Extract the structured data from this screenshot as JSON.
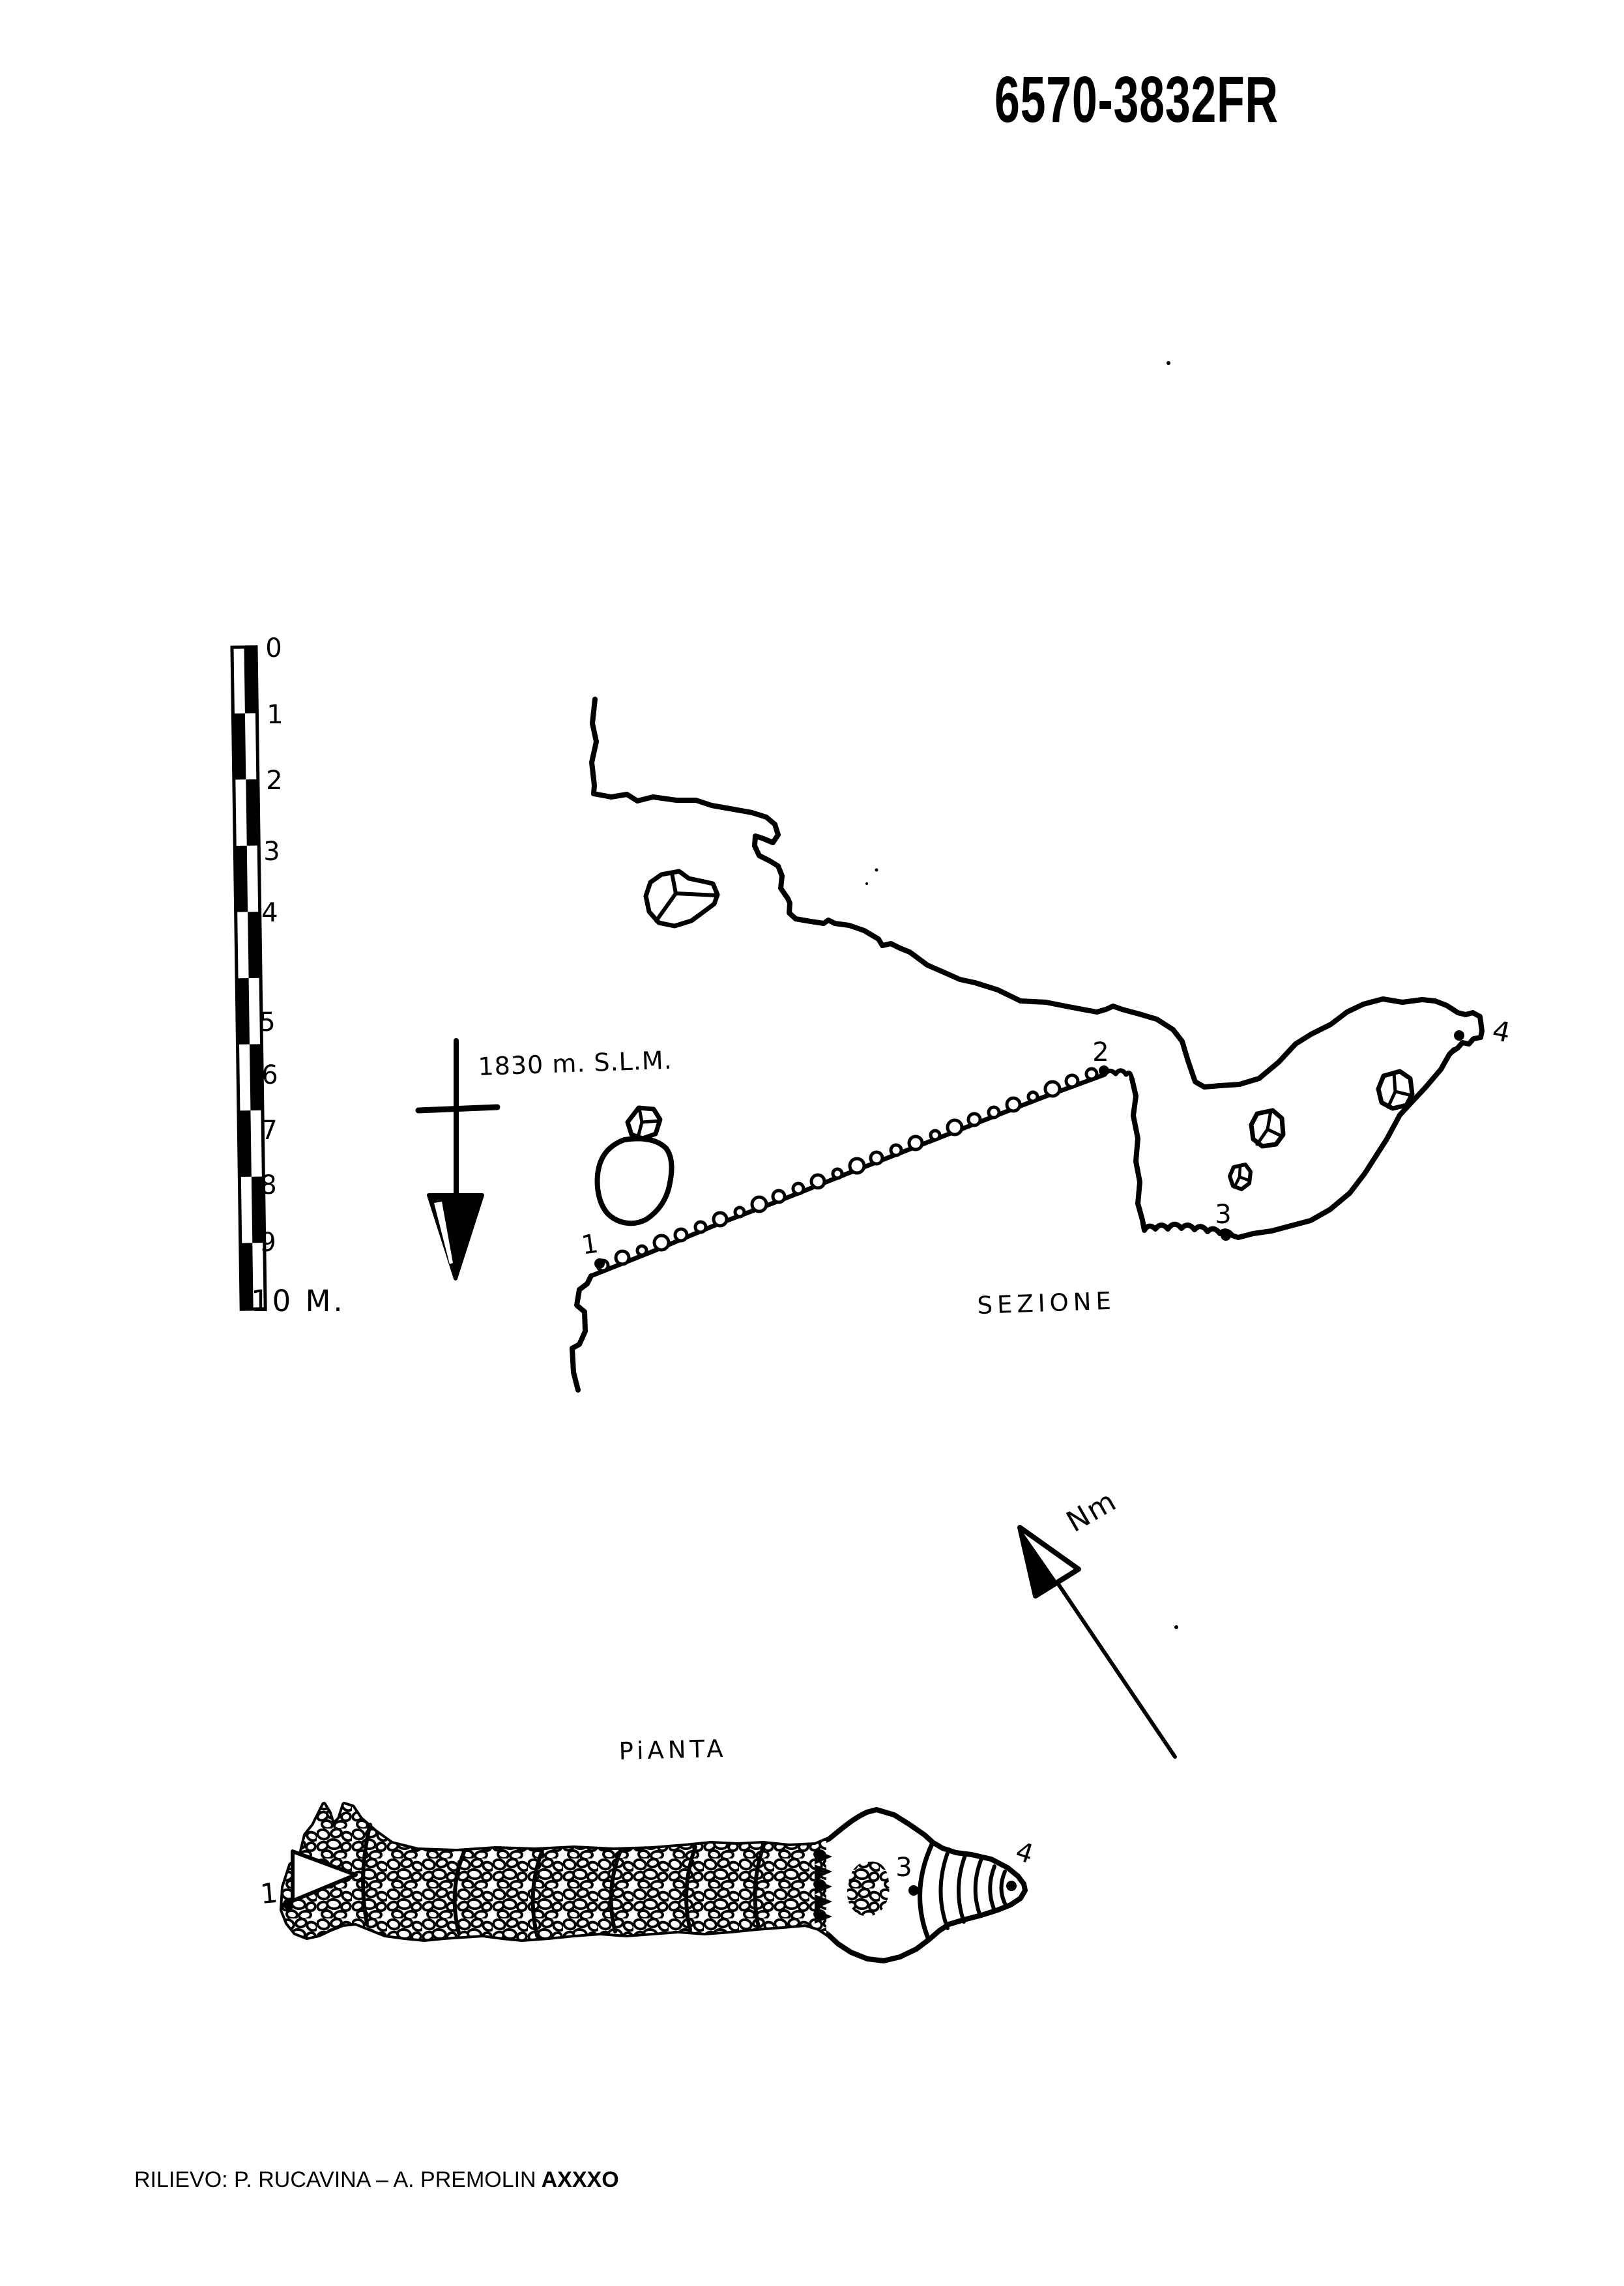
{
  "page": {
    "code": "6570-3832FR",
    "credit_prefix": "RILIEVO: P. RUCAVINA – A. PREMOLIN",
    "credit_team": "AXXXO"
  },
  "labels": {
    "section_view": "SEZIONE",
    "plan_view": "PiANTA",
    "magnetic_north": "Nm",
    "altitude": "1830 m. S.L.M."
  },
  "scale_bar": {
    "ticks": [
      "0",
      "1",
      "2",
      "3",
      "4",
      "5",
      "6",
      "7",
      "8",
      "9"
    ],
    "end_label": "10 M."
  },
  "stations": {
    "s1": "1",
    "s2": "2",
    "s3": "3",
    "s4": "4"
  },
  "colors": {
    "ink": "#000000",
    "paper": "#ffffff"
  }
}
